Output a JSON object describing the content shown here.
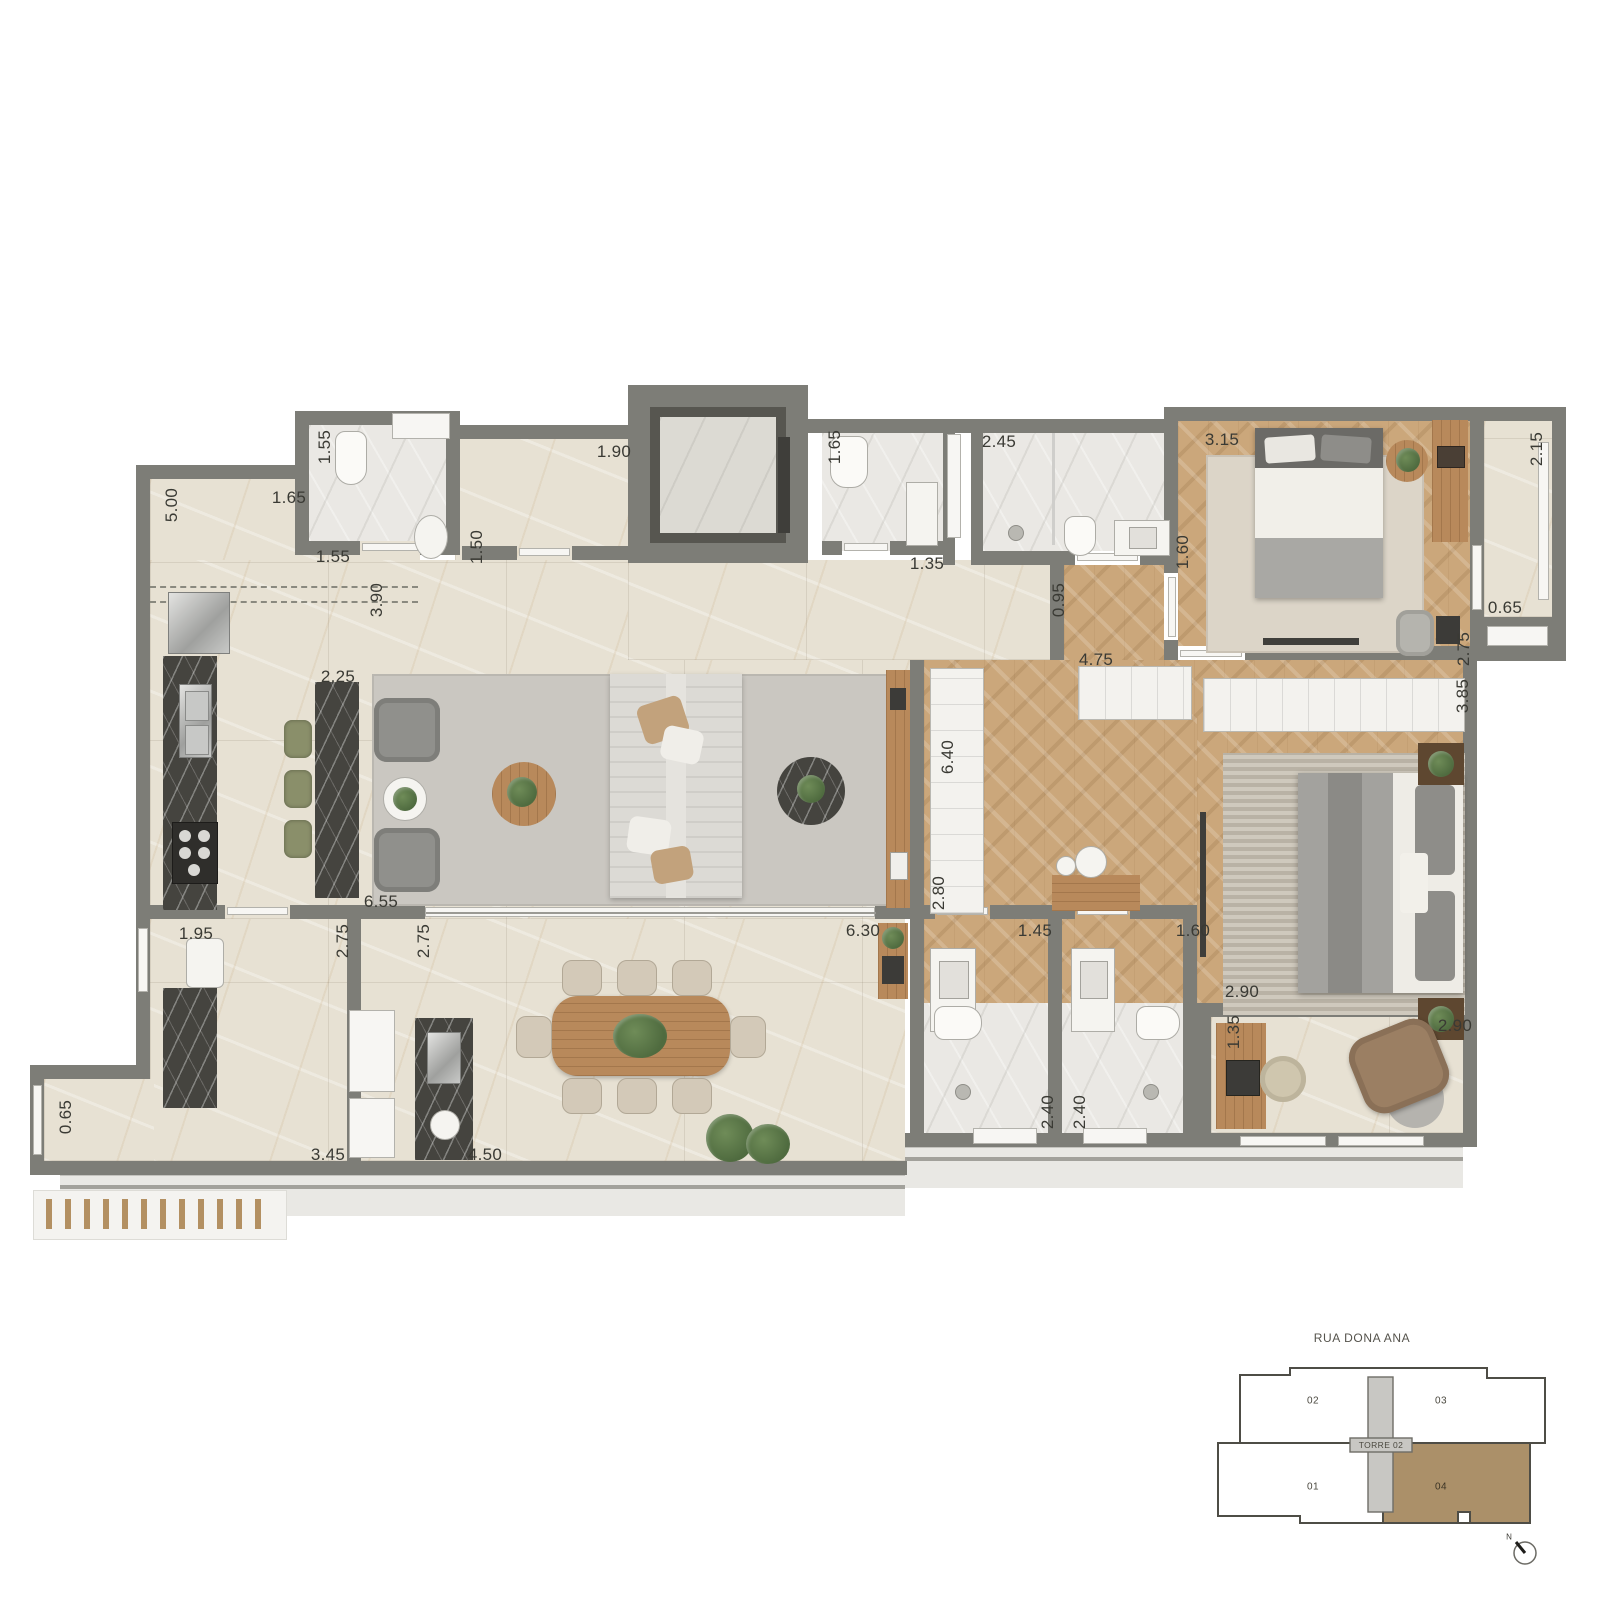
{
  "floorplan": {
    "dimension_labels": [
      {
        "value": "1.55",
        "x": 325,
        "y": 447,
        "rot": 1
      },
      {
        "value": "5.00",
        "x": 172,
        "y": 505,
        "rot": 1
      },
      {
        "value": "1.65",
        "x": 289,
        "y": 498
      },
      {
        "value": "1.55",
        "x": 333,
        "y": 557
      },
      {
        "value": "1.90",
        "x": 614,
        "y": 452
      },
      {
        "value": "1.50",
        "x": 477,
        "y": 547,
        "rot": 1
      },
      {
        "value": "3.90",
        "x": 377,
        "y": 600,
        "rot": 1
      },
      {
        "value": "2.25",
        "x": 338,
        "y": 677
      },
      {
        "value": "1.65",
        "x": 835,
        "y": 447,
        "rot": 1
      },
      {
        "value": "1.35",
        "x": 927,
        "y": 564
      },
      {
        "value": "2.45",
        "x": 999,
        "y": 442
      },
      {
        "value": "1.60",
        "x": 1183,
        "y": 552,
        "rot": 1
      },
      {
        "value": "3.15",
        "x": 1222,
        "y": 440
      },
      {
        "value": "0.95",
        "x": 1059,
        "y": 600,
        "rot": 1
      },
      {
        "value": "4.75",
        "x": 1096,
        "y": 660
      },
      {
        "value": "2.15",
        "x": 1537,
        "y": 449,
        "rot": 1
      },
      {
        "value": "0.65",
        "x": 1505,
        "y": 608
      },
      {
        "value": "2.75",
        "x": 1464,
        "y": 649,
        "rot": 1
      },
      {
        "value": "3.85",
        "x": 1463,
        "y": 696,
        "rot": 1
      },
      {
        "value": "6.40",
        "x": 948,
        "y": 757,
        "rot": 1
      },
      {
        "value": "2.80",
        "x": 939,
        "y": 893,
        "rot": 1
      },
      {
        "value": "6.55",
        "x": 381,
        "y": 902
      },
      {
        "value": "1.95",
        "x": 196,
        "y": 934
      },
      {
        "value": "2.75",
        "x": 343,
        "y": 941,
        "rot": 1
      },
      {
        "value": "2.75",
        "x": 424,
        "y": 941,
        "rot": 1
      },
      {
        "value": "6.30",
        "x": 863,
        "y": 931
      },
      {
        "value": "1.45",
        "x": 1035,
        "y": 931
      },
      {
        "value": "1.60",
        "x": 1193,
        "y": 931
      },
      {
        "value": "2.90",
        "x": 1242,
        "y": 992
      },
      {
        "value": "1.35",
        "x": 1234,
        "y": 1032,
        "rot": 1
      },
      {
        "value": "2.40",
        "x": 1048,
        "y": 1112,
        "rot": 1
      },
      {
        "value": "2.40",
        "x": 1080,
        "y": 1112,
        "rot": 1
      },
      {
        "value": "2.90",
        "x": 1455,
        "y": 1026
      },
      {
        "value": "0.65",
        "x": 66,
        "y": 1117,
        "rot": 1
      },
      {
        "value": "3.45",
        "x": 328,
        "y": 1155
      },
      {
        "value": "4.50",
        "x": 485,
        "y": 1155
      }
    ]
  },
  "keyplan": {
    "street": "RUA DONA ANA",
    "tower_label": "TORRE 02",
    "compass_label": "N",
    "units": [
      {
        "id": "02",
        "x": 1313,
        "y": 1401
      },
      {
        "id": "03",
        "x": 1441,
        "y": 1401
      },
      {
        "id": "01",
        "x": 1313,
        "y": 1487
      },
      {
        "id": "04",
        "x": 1441,
        "y": 1487,
        "hl": true
      }
    ]
  },
  "colors": {
    "wall": "#7d7d77",
    "cream_floor": "#e7e1d3",
    "wood_floor": "#cba77b",
    "bath_floor": "#eae8e4",
    "dark_marble": "#45443f",
    "unit_highlight": "#ab9069"
  }
}
